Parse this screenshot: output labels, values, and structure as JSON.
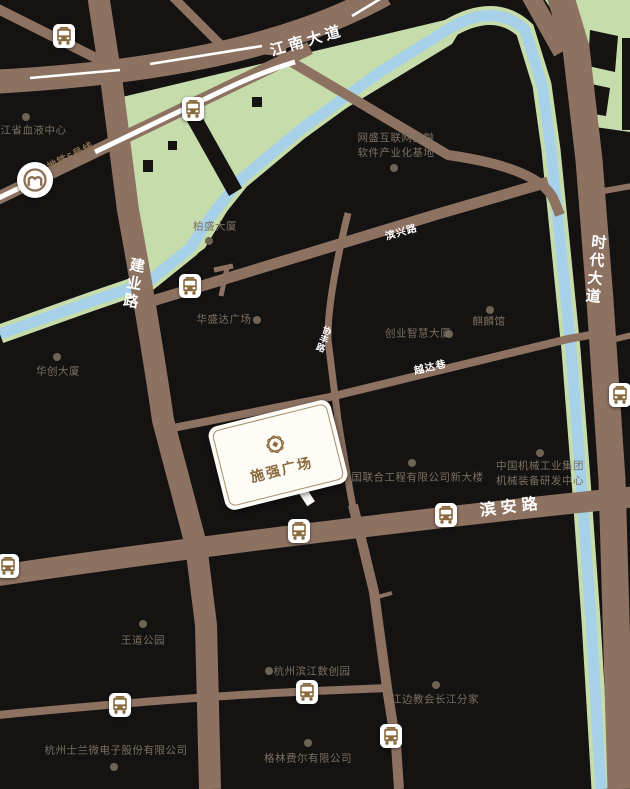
{
  "roads": {
    "jiangnan_avenue": "江南大道",
    "metro_line6": "地铁6号线",
    "jianye_road": "建业路",
    "binxing_road": "滨兴路",
    "shidai_avenue": "时代大道",
    "yueda_lane": "越达巷",
    "binan_road": "滨安路",
    "minor_road": "协丰路"
  },
  "plaza": {
    "name": "施强广场"
  },
  "metro_icon_letter": "m",
  "pois": [
    {
      "name": "浙江省血液中心"
    },
    {
      "line1": "网盛互联网金融",
      "line2": "软件产业化基地"
    },
    {
      "name": "柏盛大厦"
    },
    {
      "name": "华盛达广场"
    },
    {
      "name": "华创大厦"
    },
    {
      "name": "创业智慧大厦"
    },
    {
      "name": "麒麟馆"
    },
    {
      "name": "中国联合工程有限公司新大楼"
    },
    {
      "line1": "中国机械工业集团",
      "line2": "机械装备研发中心"
    },
    {
      "name": "王道公园"
    },
    {
      "name": "杭州滨江数创园"
    },
    {
      "name": "江边教会长江分家"
    },
    {
      "name": "杭州士兰微电子股份有限公司"
    },
    {
      "name": "格林费尔有限公司"
    }
  ],
  "colors": {
    "background": "#151212",
    "road": "#8d7262",
    "river": "#a7d1e8",
    "park": "#c6dcab",
    "brand_brown": "#8a6a3b",
    "poi_label": "#7b6f60",
    "road_label": "#ffffff"
  }
}
